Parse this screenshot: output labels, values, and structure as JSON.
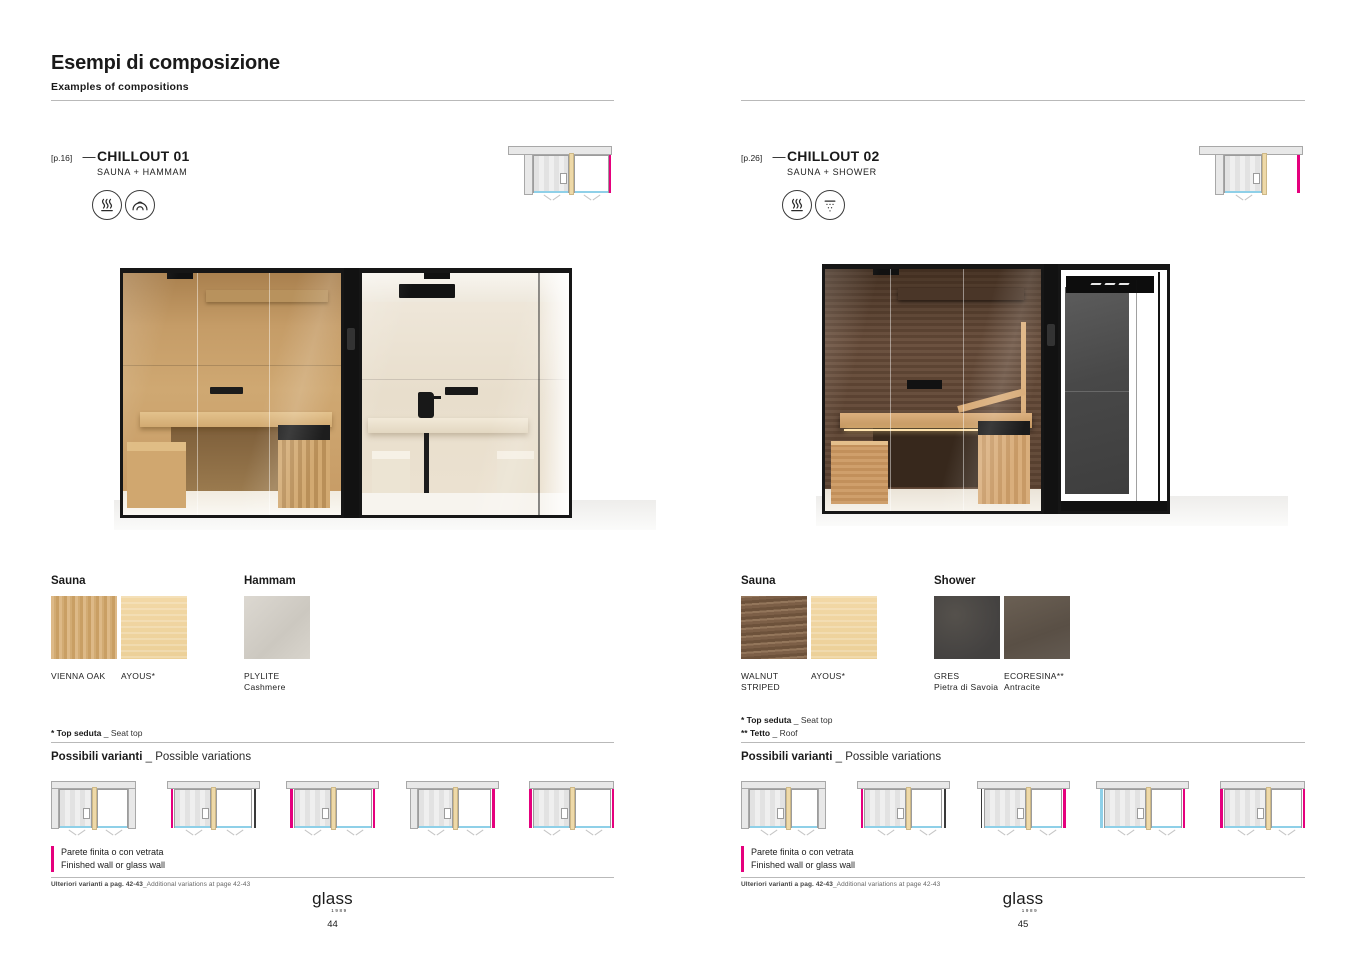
{
  "colors": {
    "accent_magenta": "#e5007d",
    "glass_blue": "#8fd0e8",
    "divider_tan": "#eed9a8",
    "wall_gray": "#e8e8e8",
    "frame_black": "#161616"
  },
  "header": {
    "title": "Esempi di composizione",
    "subtitle": "Examples of compositions"
  },
  "pages": [
    {
      "ref": "[p.16]",
      "dash": "—",
      "name": "CHILLOUT 01",
      "type": "SAUNA + HAMMAM",
      "features": [
        {
          "icon": "sauna-icon"
        },
        {
          "icon": "hammam-icon"
        }
      ],
      "materials": [
        {
          "title": "Sauna",
          "swatches": [
            {
              "label1": "VIENNA OAK",
              "label2": "",
              "texture": "vienna-oak"
            },
            {
              "label1": "AYOUS*",
              "label2": "",
              "texture": "ayous"
            }
          ]
        },
        {
          "title": "Hammam",
          "swatches": [
            {
              "label1": "PLYLITE",
              "label2": "Cashmere",
              "texture": "plylite"
            }
          ]
        }
      ],
      "footnotes": [
        {
          "it": "* Top seduta",
          "en": " _ Seat top"
        }
      ],
      "variants_heading": {
        "it": "Possibili varianti",
        "en": " _ Possible variations"
      },
      "header_plan": {
        "right_room": true
      },
      "plan_variants": [
        {
          "top": "u",
          "left": "wall",
          "right": "wall"
        },
        {
          "top": "band",
          "left": "magenta",
          "right": "dark"
        },
        {
          "top": "band",
          "left": "magenta",
          "right": "magenta"
        },
        {
          "top": "band",
          "left": "wall",
          "right": "magenta"
        },
        {
          "top": "flush",
          "left": "magenta",
          "right": "magenta"
        }
      ],
      "legend": {
        "it": "Parete finita o con vetrata",
        "en": "Finished wall or glass wall"
      },
      "more_variants": {
        "it": "Ulteriori varianti a pag. 42-43",
        "en": "_Additional variations at page 42-43"
      },
      "brand": "glass",
      "brand_year": "1989",
      "page_number": "44"
    },
    {
      "ref": "[p.26]",
      "dash": "—",
      "name": "CHILLOUT 02",
      "type": "SAUNA + SHOWER",
      "features": [
        {
          "icon": "sauna-icon"
        },
        {
          "icon": "shower-icon"
        }
      ],
      "materials": [
        {
          "title": "Sauna",
          "swatches": [
            {
              "label1": "WALNUT",
              "label2": "STRIPED",
              "texture": "walnut"
            },
            {
              "label1": "AYOUS*",
              "label2": "",
              "texture": "ayous"
            }
          ]
        },
        {
          "title": "Shower",
          "swatches": [
            {
              "label1": "GRES",
              "label2": "Pietra di Savoia",
              "texture": "gres"
            },
            {
              "label1": "ECORESINA**",
              "label2": "Antracite",
              "texture": "ecoresina"
            }
          ]
        }
      ],
      "footnotes": [
        {
          "it": "* Top seduta",
          "en": " _ Seat top"
        },
        {
          "it": "** Tetto",
          "en": " _ Roof"
        }
      ],
      "variants_heading": {
        "it": "Possibili varianti",
        "en": " _ Possible variations"
      },
      "header_plan": {
        "right_room": false
      },
      "plan_variants": [
        {
          "top": "u",
          "left": "wall",
          "right": "wall"
        },
        {
          "top": "band",
          "left": "magenta",
          "right": "dark"
        },
        {
          "top": "band",
          "left": "dark",
          "right": "magenta"
        },
        {
          "top": "band",
          "left": "blue",
          "right": "magenta"
        },
        {
          "top": "flush",
          "left": "magenta",
          "right": "magenta"
        }
      ],
      "legend": {
        "it": "Parete finita o con vetrata",
        "en": "Finished wall or glass wall"
      },
      "more_variants": {
        "it": "Ulteriori varianti a pag. 42-43",
        "en": "_Additional variations at page 42-43"
      },
      "brand": "glass",
      "brand_year": "1989",
      "page_number": "45"
    }
  ]
}
